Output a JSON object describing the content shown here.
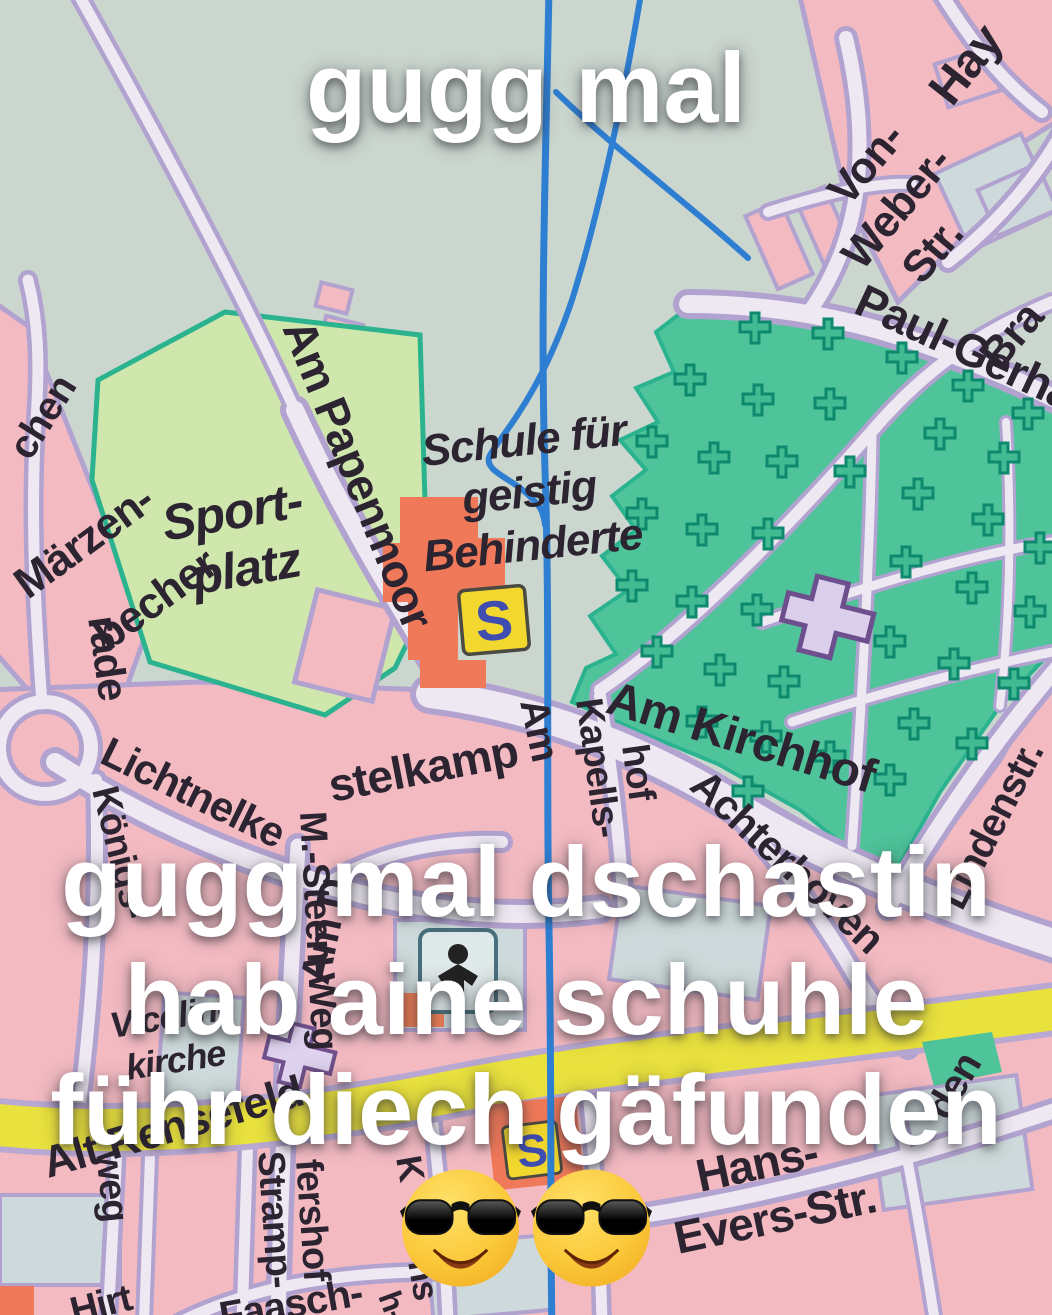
{
  "meme": {
    "caption_top": "gugg mal",
    "caption_line1": "gugg mal dschastin",
    "caption_line2": "hab aine schuhle",
    "caption_line3": "führ diech gäfunden",
    "emoji": {
      "name": "smiling-face-with-sunglasses",
      "count": 2
    }
  },
  "map": {
    "poi": {
      "school_label_line1": "Schule für",
      "school_label_line2": "geistig",
      "school_label_line3": "Behinderte",
      "sportplatz_line1": "Sport-",
      "sportplatz_line2": "platz",
      "church_line1": "Vicelin-",
      "church_line2": "kirche",
      "school_symbol": "S"
    },
    "streets": {
      "am_papenmoor": "Am Papenmoor",
      "am_kirchhof": "Am Kirchhof",
      "maerzenbecher_line1": "Märzen-",
      "maerzenbecher_line2": "becher",
      "rade": "rade",
      "chen_fragment": "chen",
      "lichtnelke": "Lichtnelke",
      "von_weber_line1": "Von-",
      "von_weber_line2": "Weber-",
      "von_weber_line3": "Str.",
      "hay_fragment": "Hay",
      "paul_gerhardt_fragment": "Paul-Gerha",
      "bra_fragment": "Bra",
      "lindenstr": "Lindenstr.",
      "den_fragment": "den",
      "achterhoven": "Achterhoven",
      "am_kapellshof_line1": "Am",
      "am_kapellshof_line2": "Kapells-",
      "am_kapellshof_line3": "hof",
      "distelkamp_line1": "Am D",
      "distelkamp_line2": "stelkamp",
      "m_steen_weg": "M.-Steen-Weg",
      "koenigs_fragment": "Königs-",
      "alt_rensefeld": "Alt Rensefeld",
      "hans_evers_line1": "Hans-",
      "hans_evers_line2": "Evers-Str.",
      "weg_fragment": "weg",
      "strampfershof_line1": "Stramp-",
      "strampfershof_line2": "fershof",
      "faasch_fragment": "Faasch-",
      "hirten_fragment": "Hirt",
      "k_fragment": "K",
      "ns_fragment": "ns",
      "h_fragment": "h-"
    },
    "colors": {
      "background": "#cbd6cf",
      "blocks_pink": "#f3bac2",
      "block_outline": "#b2a2cf",
      "road_fill": "#ede8f2",
      "cemetery_green": "#4fc39a",
      "cross_teal": "#0d8a6e",
      "sportplatz_green": "#cfe7ac",
      "sport_border": "#2bb390",
      "water_blue": "#2e7ed2",
      "main_road_yellow": "#e9e13e",
      "building_red": "#f0795a",
      "school_sign_yellow": "#f2d72e",
      "school_sign_blue": "#3f4cb0",
      "label_dark": "#2c2430"
    }
  }
}
